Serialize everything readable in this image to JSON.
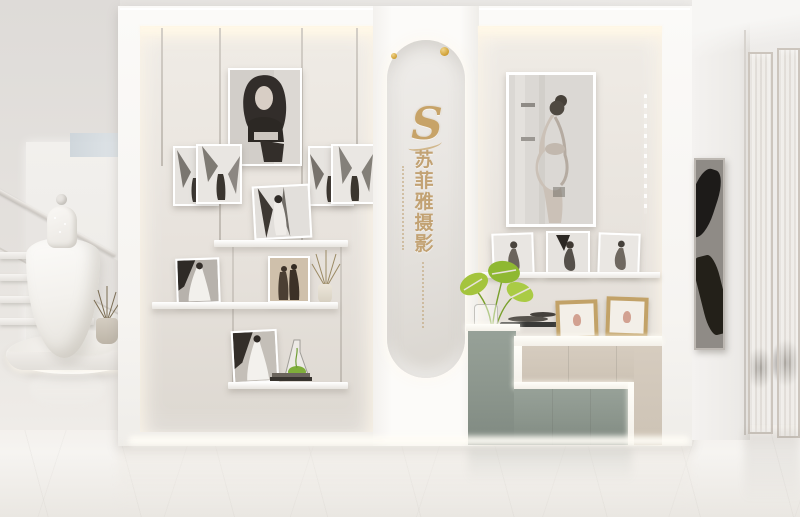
{
  "scene": {
    "type": "interior-photo",
    "setting": "Bridal and maternity photography studio — white display wall with lit niches, center arched brand panel, stepped cabinet, staircase with wedding gown mannequin, fluted glass partition",
    "brand": {
      "logo_letter": "S",
      "name": "苏菲雅摄影",
      "name_chars": [
        "苏",
        "菲",
        "雅",
        "摄",
        "影"
      ],
      "accent_gold": "#c2a273"
    },
    "left_niche": {
      "items": [
        "hanging rods",
        "large b&w woman portrait",
        "two pairs of small b&w prints",
        "leaning wedding print on floating shelf",
        "bride photo",
        "sepia couple photo",
        "vase with dried flowers",
        "bride photo on lower shelf",
        "glass flask with greenery",
        "book stack"
      ]
    },
    "right_niche": {
      "items": [
        "large framed maternity portrait",
        "three leaning maternity prints on ledge",
        "hanging crystal strand",
        "monstera plant",
        "glass vase",
        "dark trays",
        "two wooden photo frames",
        "stepped cabinet"
      ]
    },
    "surroundings": {
      "left": [
        "staircase with glass balustrade",
        "white wedding dress on mannequin",
        "round display platform",
        "potted dried plant"
      ],
      "right": [
        "white wall with dark abstract artwork",
        "fluted glass partitions",
        "glossy marble floor"
      ]
    },
    "palette": {
      "wall": "#e7e4e1",
      "unit_white": "#f8f7f5",
      "niche_back": "#e7e2dc",
      "led_warm": "#fff8e8",
      "cabinet_beige": "#cfc5b8",
      "cabinet_green": "#8e988f",
      "gold": "#c7a368",
      "plant_green": "#a3c33c",
      "floor": "#f3f0ec"
    }
  }
}
